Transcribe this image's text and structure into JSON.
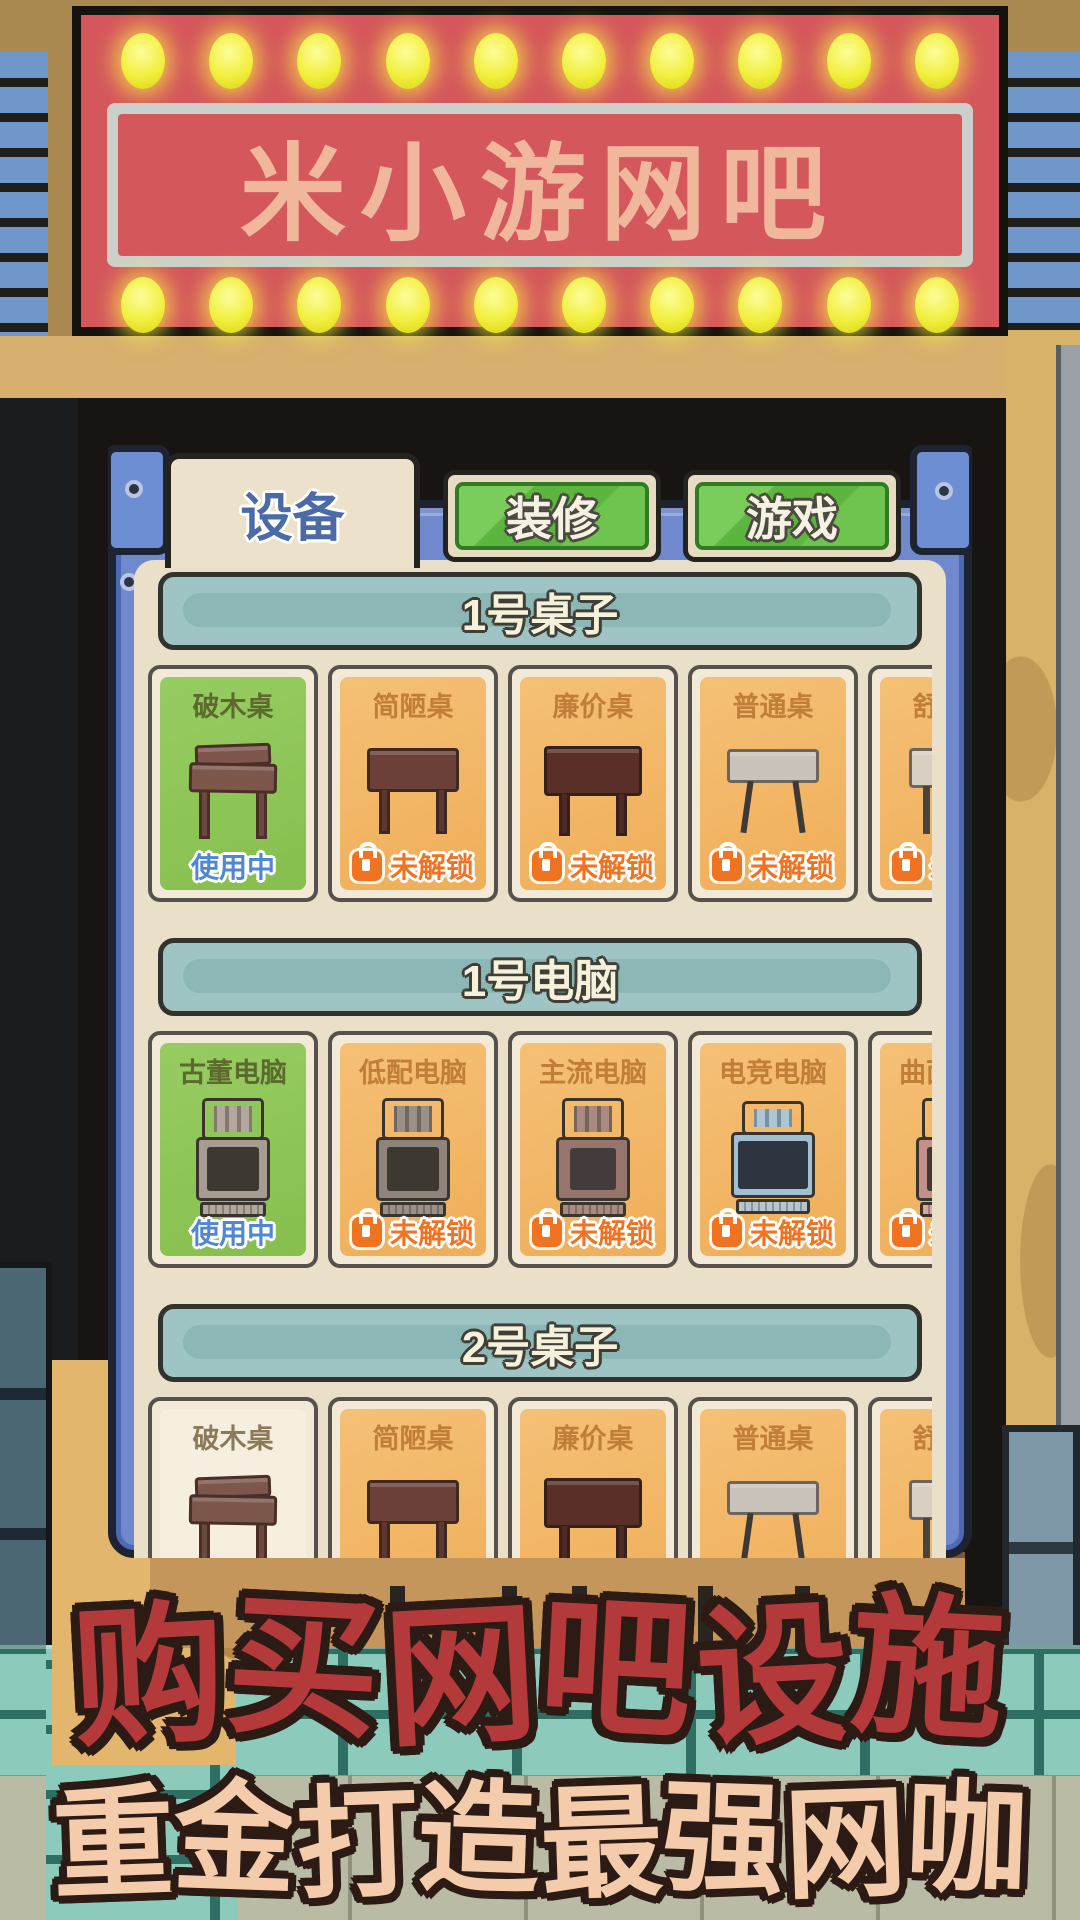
{
  "sign": {
    "title": "米小游网吧"
  },
  "tabs": [
    {
      "label": "设备",
      "active": true
    },
    {
      "label": "装修",
      "active": false
    },
    {
      "label": "游戏",
      "active": false
    }
  ],
  "panel": {
    "sections": [
      {
        "title": "1号桌子",
        "items": [
          {
            "label": "破木桌",
            "art": "table-broken",
            "state": "inuse",
            "status": "使用中"
          },
          {
            "label": "简陋桌",
            "art": "table-crude",
            "state": "locked",
            "status": "未解锁"
          },
          {
            "label": "廉价桌",
            "art": "table-cheap",
            "state": "locked",
            "status": "未解锁"
          },
          {
            "label": "普通桌",
            "art": "table-normal",
            "state": "locked",
            "status": "未解锁"
          },
          {
            "label": "舒适桌",
            "art": "table-comfort",
            "state": "locked",
            "status": "未解锁",
            "partial": true
          }
        ]
      },
      {
        "title": "1号电脑",
        "items": [
          {
            "label": "古董电脑",
            "art": "pc-antique",
            "state": "inuse",
            "status": "使用中"
          },
          {
            "label": "低配电脑",
            "art": "pc-low",
            "state": "locked",
            "status": "未解锁"
          },
          {
            "label": "主流电脑",
            "art": "pc-main",
            "state": "locked",
            "status": "未解锁"
          },
          {
            "label": "电竞电脑",
            "art": "pc-gaming",
            "state": "locked",
            "status": "未解锁"
          },
          {
            "label": "曲面电脑",
            "art": "pc-curved",
            "state": "locked",
            "status": "未解锁",
            "partial": true
          }
        ]
      },
      {
        "title": "2号桌子",
        "items": [
          {
            "label": "破木桌",
            "art": "table-broken",
            "state": "owned",
            "status": ""
          },
          {
            "label": "简陋桌",
            "art": "table-crude",
            "state": "locked",
            "status": ""
          },
          {
            "label": "廉价桌",
            "art": "table-cheap",
            "state": "locked",
            "status": ""
          },
          {
            "label": "普通桌",
            "art": "table-normal",
            "state": "locked",
            "status": ""
          },
          {
            "label": "舒适桌",
            "art": "table-comfort",
            "state": "locked",
            "status": "",
            "partial": true
          }
        ]
      }
    ]
  },
  "promo": {
    "line1": "购买网吧设施",
    "line2": "重金打造最强网咖"
  },
  "colors": {
    "sign_red": "#d4575c",
    "bulb_yellow": "#f2ef3e",
    "sign_text_peach": "#f0b79d",
    "tab_green": "#5cb53e",
    "tab_text_blue": "#4a6aa8",
    "panel_blue": "#7089cd",
    "panel_cream": "#eadfc9",
    "section_teal": "#9fc4c4",
    "in_use_green": "#8cc457",
    "locked_orange": "#efae58",
    "status_blue": "#4f86d8",
    "lock_orange": "#f07321",
    "promo_red": "#b4393a",
    "promo_peach": "#f4cbab"
  },
  "icons": [
    "bulb-icon",
    "lock-icon"
  ]
}
